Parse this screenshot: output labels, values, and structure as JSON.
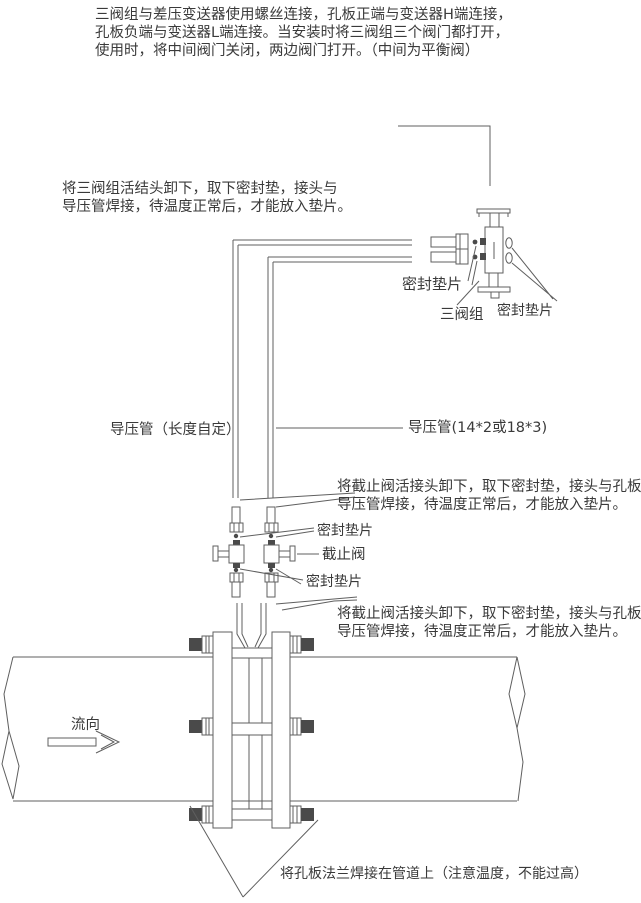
{
  "colors": {
    "background": "#ffffff",
    "text": "#3a3a3a",
    "line": "#5f5f5f",
    "dark_fill": "#4a4a4a"
  },
  "top_note": {
    "lines": [
      "三阀组与差压变送器使用螺丝连接，孔板正端与变送器H端连接，",
      "孔板负端与变送器L端连接。当安装时将三阀组三个阀门都打开，",
      "使用时，将中间阀门关闭，两边阀门打开。（中间为平衡阀）"
    ]
  },
  "manifold_note": {
    "lines": [
      "将三阀组活结头卸下，取下密封垫，接头与",
      "导压管焊接，待温度正常后，才能放入垫片。"
    ]
  },
  "labels": {
    "seal_gasket_left": "密封垫片",
    "manifold": "三阀组",
    "seal_gasket_right": "密封垫片",
    "impulse_pipe_left": "导压管（长度自定）",
    "impulse_pipe_right": "导压管(14*2或18*3)",
    "valve_seal_gasket_top": "密封垫片",
    "shutoff_valve": "截止阀",
    "valve_seal_gasket_bottom": "密封垫片",
    "flow_direction": "流向"
  },
  "shutoff_note_upper": {
    "lines": [
      "将截止阀活接头卸下，取下密封垫，接头与孔板",
      "导压管焊接，待温度正常后，才能放入垫片。"
    ]
  },
  "shutoff_note_lower": {
    "lines": [
      "将截止阀活接头卸下，取下密封垫，接头与孔板",
      "导压管焊接，待温度正常后，才能放入垫片。"
    ]
  },
  "bottom_note": "将孔板法兰焊接在管道上（注意温度，不能过高）"
}
